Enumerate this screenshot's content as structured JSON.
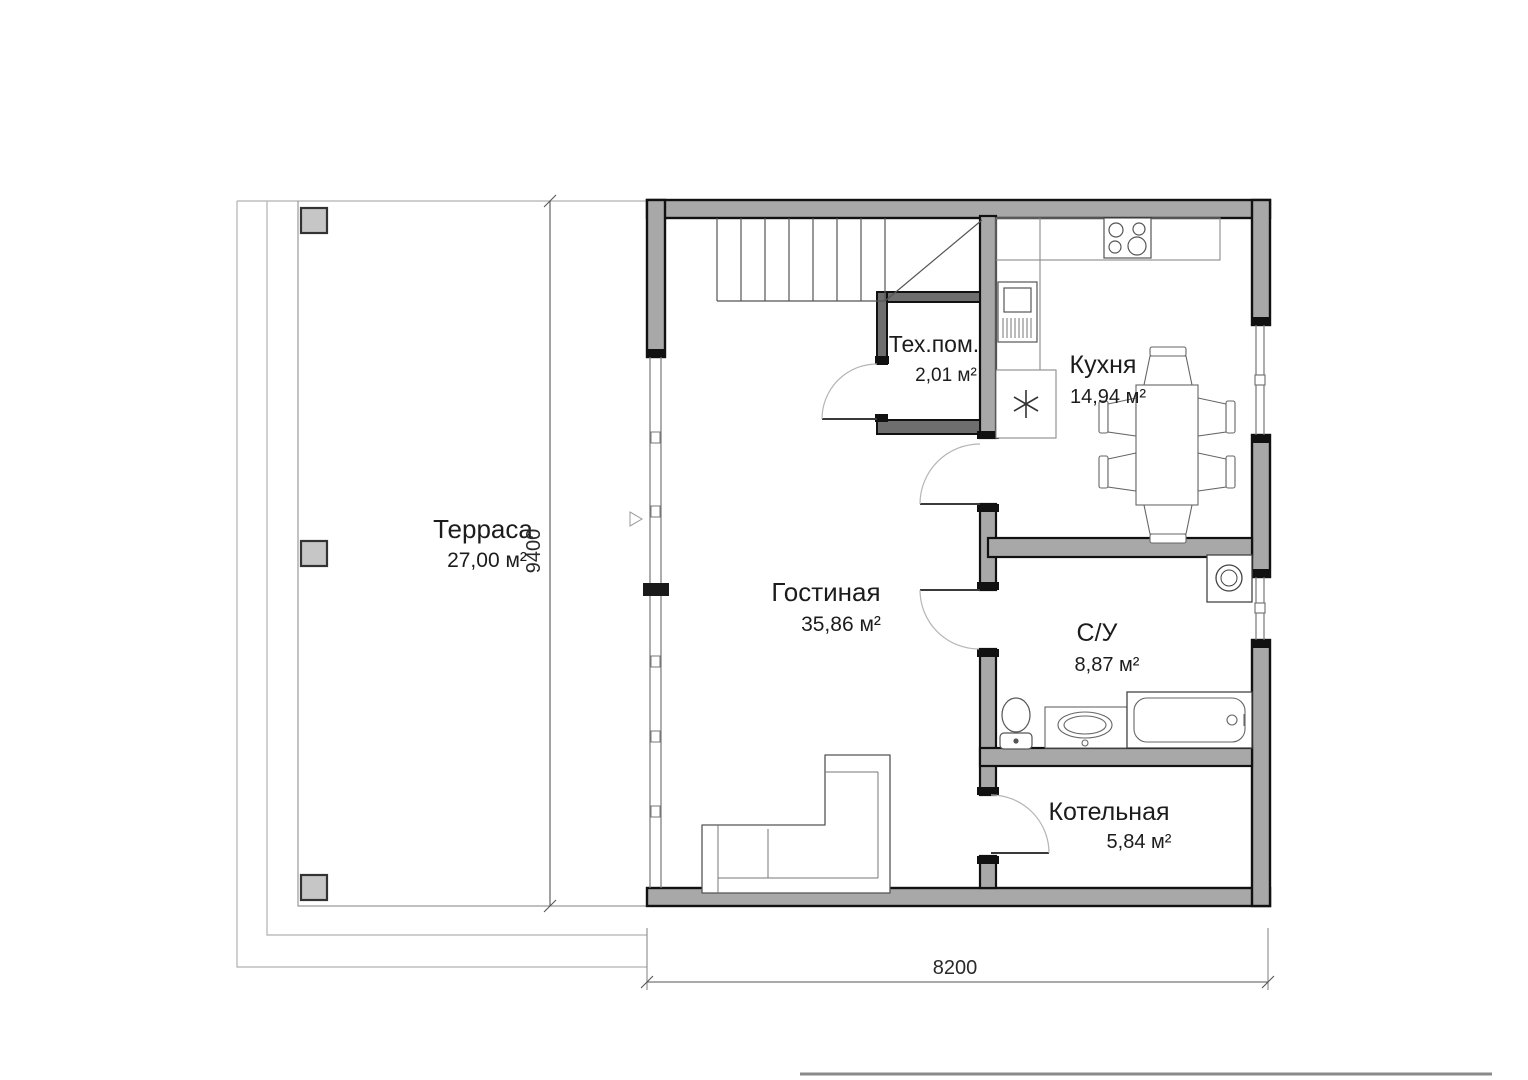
{
  "drawing": {
    "rooms": {
      "terrace": {
        "name": "Терраса",
        "area": "27,00 м²"
      },
      "living_room": {
        "name": "Гостиная",
        "area": "35,86 м²"
      },
      "tech_room": {
        "name": "Тех.пом.",
        "area": "2,01 м²"
      },
      "kitchen": {
        "name": "Кухня",
        "area": "14,94 м²"
      },
      "bathroom": {
        "name": "С/У",
        "area": "8,87 м²"
      },
      "boiler_room": {
        "name": "Котельная",
        "area": "5,84 м²"
      }
    },
    "dimensions": {
      "overall_width_mm": "8200",
      "overall_depth_mm": "9400"
    },
    "colors": {
      "wall_fill": "#a8a8a8",
      "wall_outline": "#111111",
      "thin_line": "#8a8a8a",
      "text": "#1c1c1c"
    }
  }
}
